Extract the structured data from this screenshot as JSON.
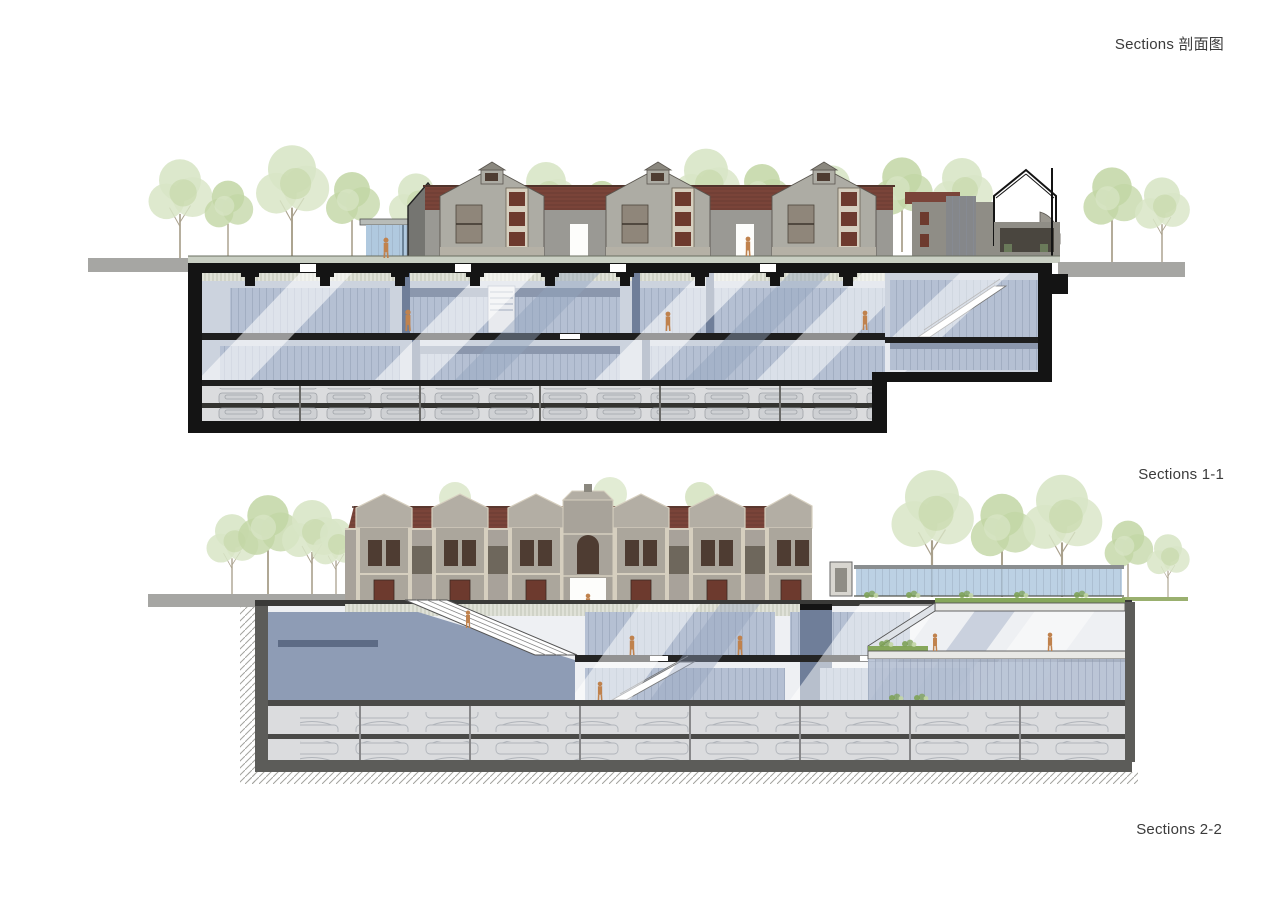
{
  "page": {
    "title": "Sections 剖面图"
  },
  "sections": [
    {
      "id": "1-1",
      "label": "Sections 1-1"
    },
    {
      "id": "2-2",
      "label": "Sections 2-2"
    }
  ],
  "colors": {
    "paper": "#ffffff",
    "ink": "#3b3b3b",
    "black": "#141414",
    "roofRed": "#7a4439",
    "roofDark": "#50332b",
    "wallGray": "#9a9994",
    "wallGray2": "#a8a29a",
    "gableLight": "#adaca4",
    "bayLight": "#b3aea4",
    "trimCream": "#d6cfbf",
    "windowDark": "#4e3c32",
    "windowRed": "#6d3a2e",
    "groundGray": "#a6a6a3",
    "pavement": "#c9cfc3",
    "bgBlue": "#ccd3de",
    "bgLight": "#eef0f3",
    "glassBlue": "#b5c0d3",
    "mullion": "#8b97ad",
    "poche": "#8e9cb5",
    "pocheDark": "#6f7e99",
    "ceilBand": "#e0e2d8",
    "ceilLine": "#b9bdae",
    "parkGray": "#dbdcde",
    "carFill": "#cfd1d4",
    "carLine": "#9fa3a8",
    "slabDark": "#1e1e1e",
    "slabMid": "#4a4a48",
    "earthGray": "#5c5c59",
    "hatchLine": "#a3a39e",
    "figure": "#c0824d",
    "pavilionGlass": "#b0c9df",
    "treeLight": "#d8e5c6",
    "treeGreen": "#c2d6a4",
    "trunk": "#a9a08c",
    "shrub": "#7da256",
    "grass": "#9ab06f",
    "beamBlue": "#93a3bd"
  }
}
